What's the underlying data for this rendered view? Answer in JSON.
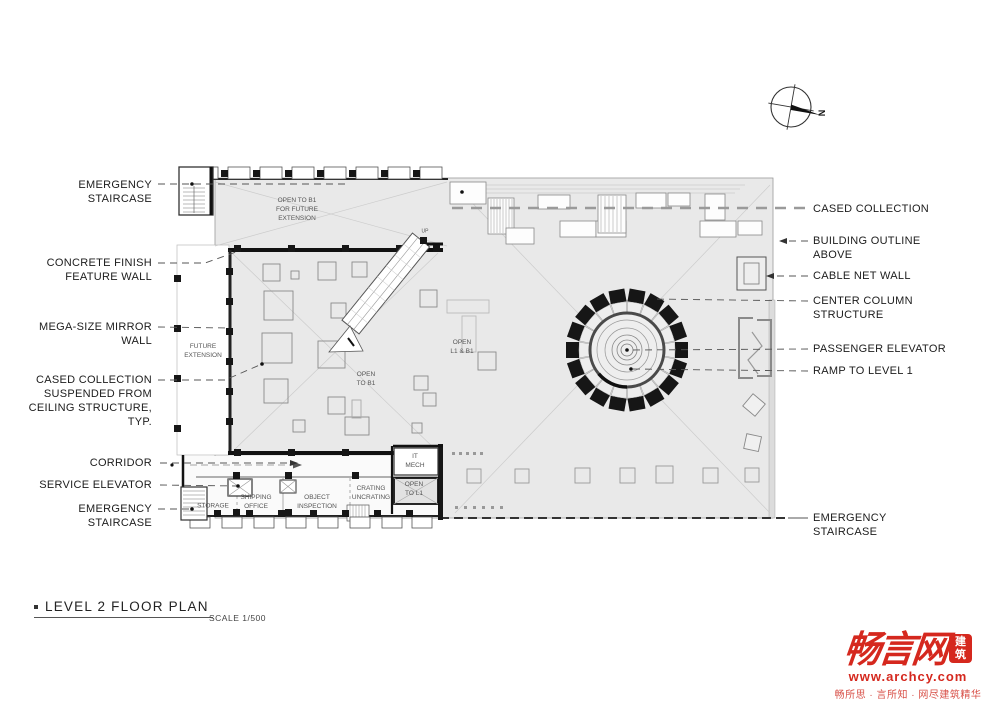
{
  "drawing": {
    "title": "LEVEL 2  FLOOR PLAN",
    "scale": "SCALE 1/500",
    "north_label": "N"
  },
  "annotations": {
    "left": [
      {
        "text": "EMERGENCY\nSTAIRCASE"
      },
      {
        "text": "CONCRETE FINISH\nFEATURE WALL"
      },
      {
        "text": "MEGA-SIZE MIRROR\nWALL"
      },
      {
        "text": "CASED COLLECTION\nSUSPENDED FROM\nCEILING STRUCTURE,\nTYP."
      },
      {
        "text": "CORRIDOR"
      },
      {
        "text": "SERVICE ELEVATOR"
      },
      {
        "text": "EMERGENCY\nSTAIRCASE"
      }
    ],
    "right": [
      {
        "text": "CASED COLLECTION"
      },
      {
        "text": "BUILDING OUTLINE\nABOVE"
      },
      {
        "text": "CABLE NET WALL"
      },
      {
        "text": "CENTER COLUMN\nSTRUCTURE"
      },
      {
        "text": "PASSENGER ELEVATOR"
      },
      {
        "text": "RAMP TO LEVEL 1"
      },
      {
        "text": "EMERGENCY\nSTAIRCASE"
      }
    ]
  },
  "plan_labels": {
    "open_to_b1_future": "OPEN TO B1\nFOR FUTURE\nEXTENSION",
    "future_extension": "FUTURE\nEXTENSION",
    "open_to_b1": "OPEN\nTO B1",
    "open_l1_b1": "OPEN\nL1 & B1",
    "up": "UP",
    "it_mech": "IT\nMECH",
    "open_to_l1": "OPEN\nTO L1",
    "crating_uncrating": "CRATING\nUNCRATING",
    "object_inspection": "OBJECT\nINSPECTION",
    "shipping_office": "SHIPPING\nOFFICE",
    "storage": "STORAGE"
  },
  "logo": {
    "brand": "畅言网",
    "seal": "建筑",
    "url": "www.archcy.com",
    "tagline": "畅所思 · 言所知 · 网尽建筑精华",
    "color": "#d5281e"
  },
  "colors": {
    "plan_fill": "#e9e9e9",
    "wall": "#161616",
    "accent_red": "#d5281e"
  }
}
